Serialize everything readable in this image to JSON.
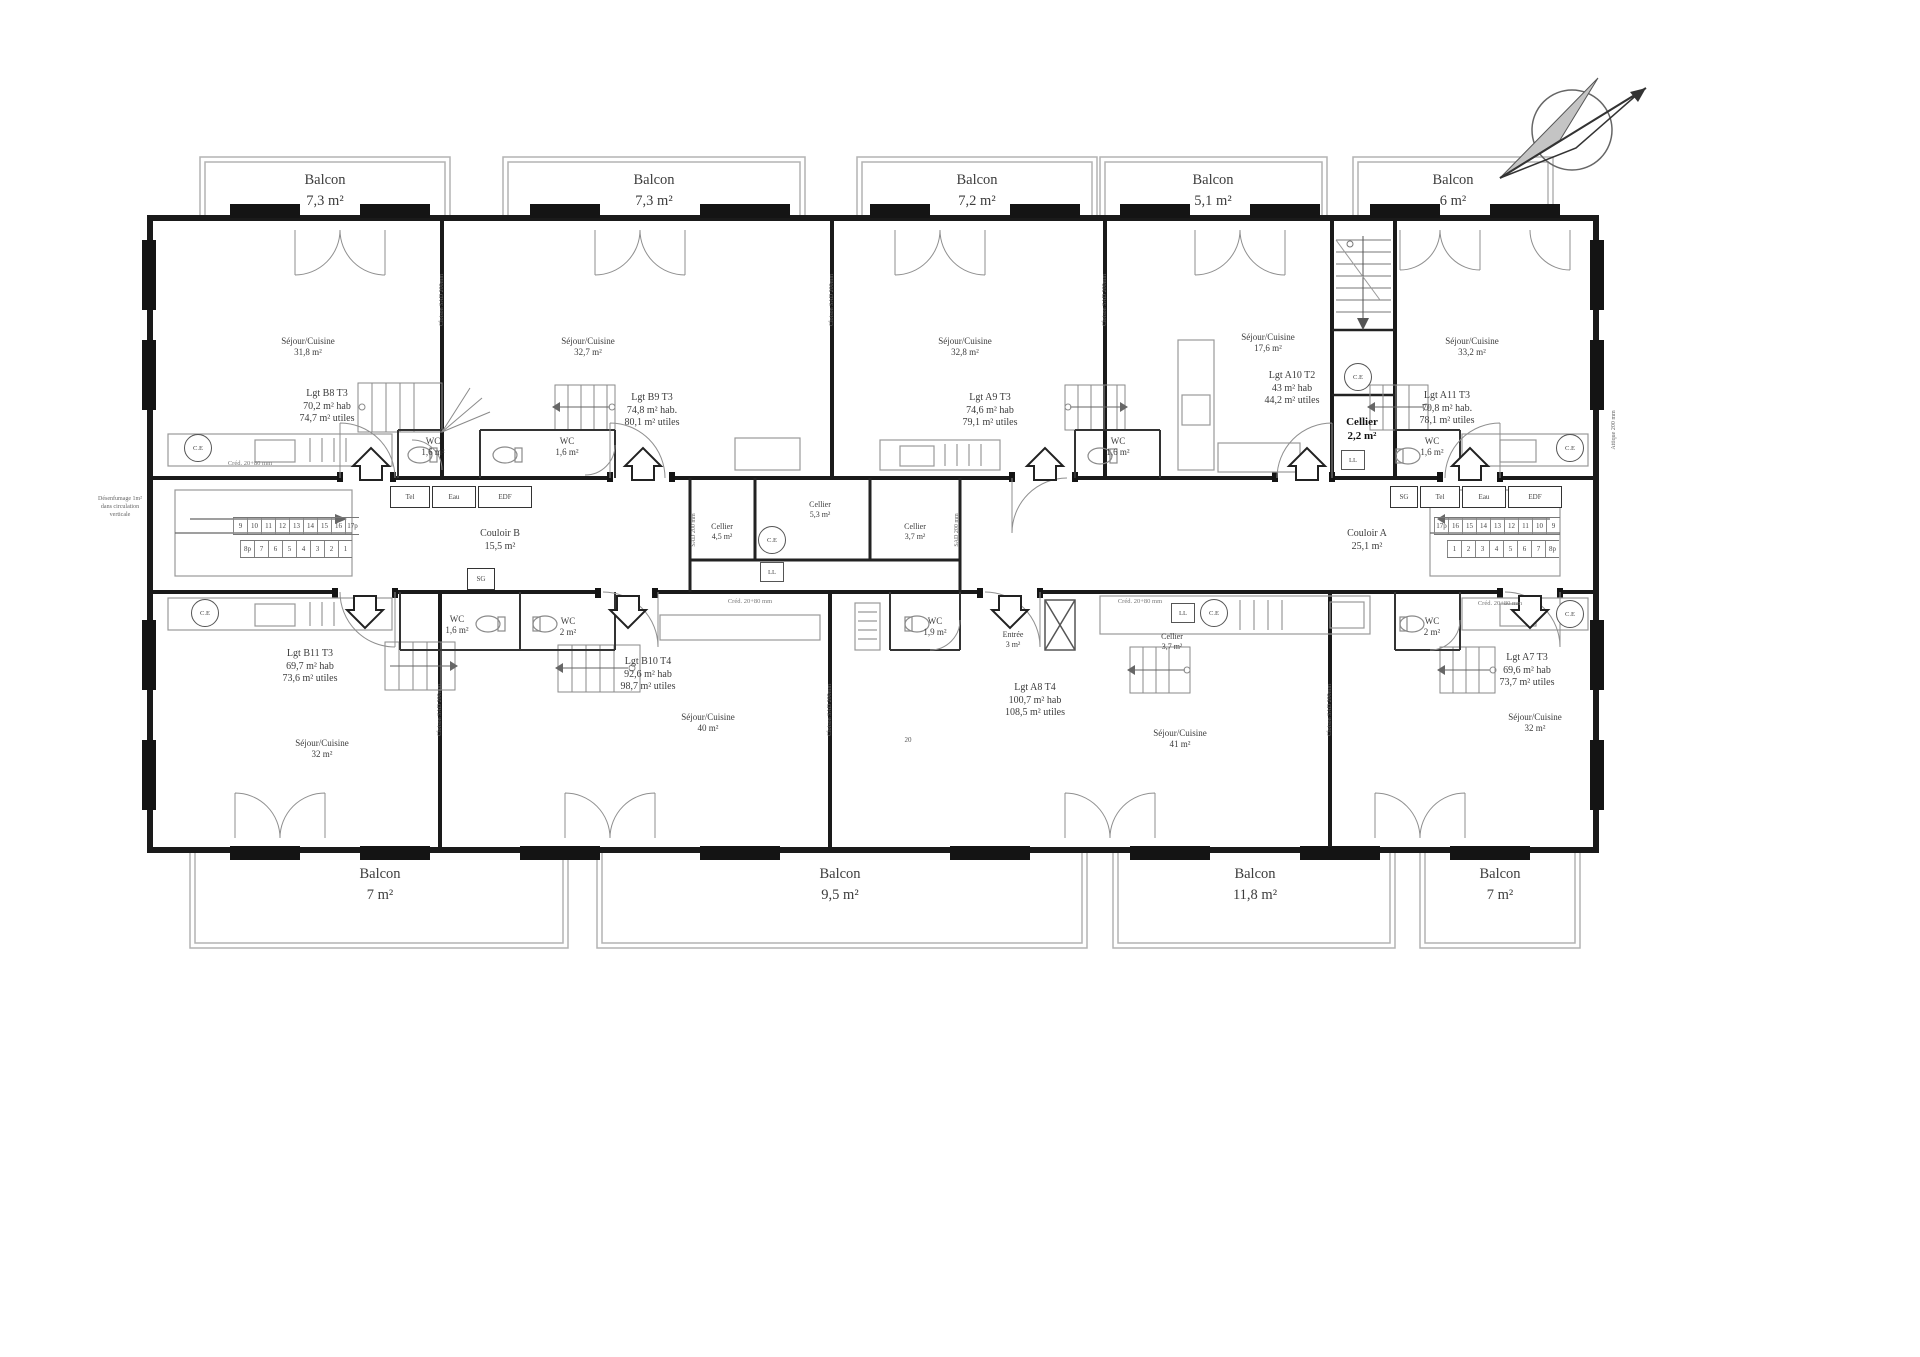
{
  "balconies_top": [
    {
      "label": "Balcon",
      "area": "7,3 m²"
    },
    {
      "label": "Balcon",
      "area": "7,3 m²"
    },
    {
      "label": "Balcon",
      "area": "7,2 m²"
    },
    {
      "label": "Balcon",
      "area": "5,1 m²"
    },
    {
      "label": "Balcon",
      "area": "6 m²"
    }
  ],
  "balconies_bottom": [
    {
      "label": "Balcon",
      "area": "7 m²"
    },
    {
      "label": "Balcon",
      "area": "9,5 m²"
    },
    {
      "label": "Balcon",
      "area": "11,8 m²"
    },
    {
      "label": "Balcon",
      "area": "7 m²"
    }
  ],
  "units": {
    "b8": {
      "id": "Lgt B8 T3",
      "hab": "70,2 m² hab",
      "utiles": "74,7 m² utiles",
      "room": "Séjour/Cuisine",
      "room_area": "31,8 m²",
      "wc": "WC",
      "wc_area": "1,6 m²"
    },
    "b9": {
      "id": "Lgt B9 T3",
      "hab": "74,8 m² hab.",
      "utiles": "80,1 m² utiles",
      "room": "Séjour/Cuisine",
      "room_area": "32,7 m²",
      "wc": "WC",
      "wc_area": "1,6 m²"
    },
    "a9": {
      "id": "Lgt A9 T3",
      "hab": "74,6 m² hab",
      "utiles": "79,1 m² utiles",
      "room": "Séjour/Cuisine",
      "room_area": "32,8 m²",
      "wc": "WC",
      "wc_area": "1,6 m²"
    },
    "a10": {
      "id": "Lgt A10 T2",
      "hab": "43 m² hab",
      "utiles": "44,2 m² utiles",
      "room": "Séjour/Cuisine",
      "room_area": "17,6 m²",
      "cellier": "Cellier",
      "cellier_area": "2,2 m²"
    },
    "a11": {
      "id": "Lgt A11 T3",
      "hab": "70,8 m² hab.",
      "utiles": "78,1 m² utiles",
      "room": "Séjour/Cuisine",
      "room_area": "33,2 m²",
      "wc": "WC",
      "wc_area": "1,6 m²"
    },
    "b11": {
      "id": "Lgt B11 T3",
      "hab": "69,7 m² hab",
      "utiles": "73,6 m² utiles",
      "room": "Séjour/Cuisine",
      "room_area": "32 m²",
      "wc": "WC",
      "wc_area": "1,6 m²"
    },
    "b10": {
      "id": "Lgt B10 T4",
      "hab": "92,6 m² hab",
      "utiles": "98,7 m² utiles",
      "room": "Séjour/Cuisine",
      "room_area": "40 m²",
      "wc": "WC",
      "wc_area": "2 m²"
    },
    "a8": {
      "id": "Lgt A8 T4",
      "hab": "100,7 m² hab",
      "utiles": "108,5 m² utiles",
      "room": "Séjour/Cuisine",
      "room_area": "41 m²",
      "wc": "WC",
      "wc_area": "1,9 m²",
      "entree": "Entrée",
      "entree_area": "3 m²",
      "cellier": "Cellier",
      "cellier_area": "3,7 m²"
    },
    "a7": {
      "id": "Lgt A7 T3",
      "hab": "69,6 m² hab",
      "utiles": "73,7 m² utiles",
      "room": "Séjour/Cuisine",
      "room_area": "32 m²",
      "wc": "WC",
      "wc_area": "2 m²"
    }
  },
  "corridors": {
    "b": {
      "name": "Couloir B",
      "area": "15,5 m²"
    },
    "a": {
      "name": "Couloir A",
      "area": "25,1 m²"
    }
  },
  "celliers_center": [
    {
      "label": "Cellier",
      "area": "4,5 m²"
    },
    {
      "label": "Cellier",
      "area": "5,3 m²"
    },
    {
      "label": "Cellier",
      "area": "3,7 m²"
    }
  ],
  "labels": {
    "ce": "C.E",
    "ll": "LL",
    "tel": "Tel",
    "eau": "Eau",
    "edf": "EDF",
    "sg": "SG"
  },
  "stairs": {
    "left_run_up": [
      "9",
      "10",
      "11",
      "12",
      "13",
      "14",
      "15",
      "16",
      "17p"
    ],
    "left_run_down": [
      "8p",
      "7",
      "6",
      "5",
      "4",
      "3",
      "2",
      "1"
    ],
    "right_run_up": [
      "17p",
      "16",
      "15",
      "14",
      "13",
      "12",
      "11",
      "10",
      "9"
    ],
    "right_run_down": [
      "1",
      "2",
      "3",
      "4",
      "5",
      "6",
      "7",
      "8p"
    ]
  },
  "annotations": {
    "wall": "Cloison SAD 200mm",
    "wall_short": "SAD 200 mm",
    "kitchen": "Créd. 20+80 mm",
    "right_edge": "Attique 200 mm",
    "dim20": "20",
    "smoke1": "Désenfumage 1m²",
    "smoke2": "dans circulation",
    "smoke3": "verticale"
  }
}
